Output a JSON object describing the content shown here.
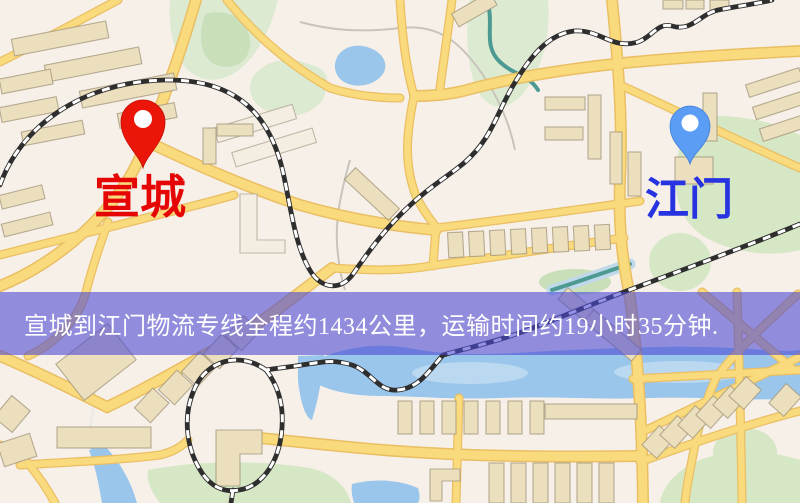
{
  "map": {
    "origin_label": "宣城",
    "origin_label_color": "#e60505",
    "origin_pin_color": "#ec1509",
    "destination_label": "江门",
    "destination_label_color": "#2733e0",
    "destination_pin_color": "#5b9cf4"
  },
  "banner": {
    "text": "宣城到江门物流专线全程约1434公里，运输时间约19小时35分钟.",
    "overlay_color": "rgba(76,74,212,0.60)",
    "text_color": "#ffffff"
  },
  "palette": {
    "background": "#f7f0e9",
    "road_fill": "#f9da7d",
    "road_edge": "#eabf63",
    "building_fill": "#ebdfbe",
    "building_edge": "#a1947a",
    "water": "#9ac6ec",
    "green": "#d6e7c6",
    "railway": "#2e2e2e",
    "stream_teal": "#4d9a92"
  }
}
